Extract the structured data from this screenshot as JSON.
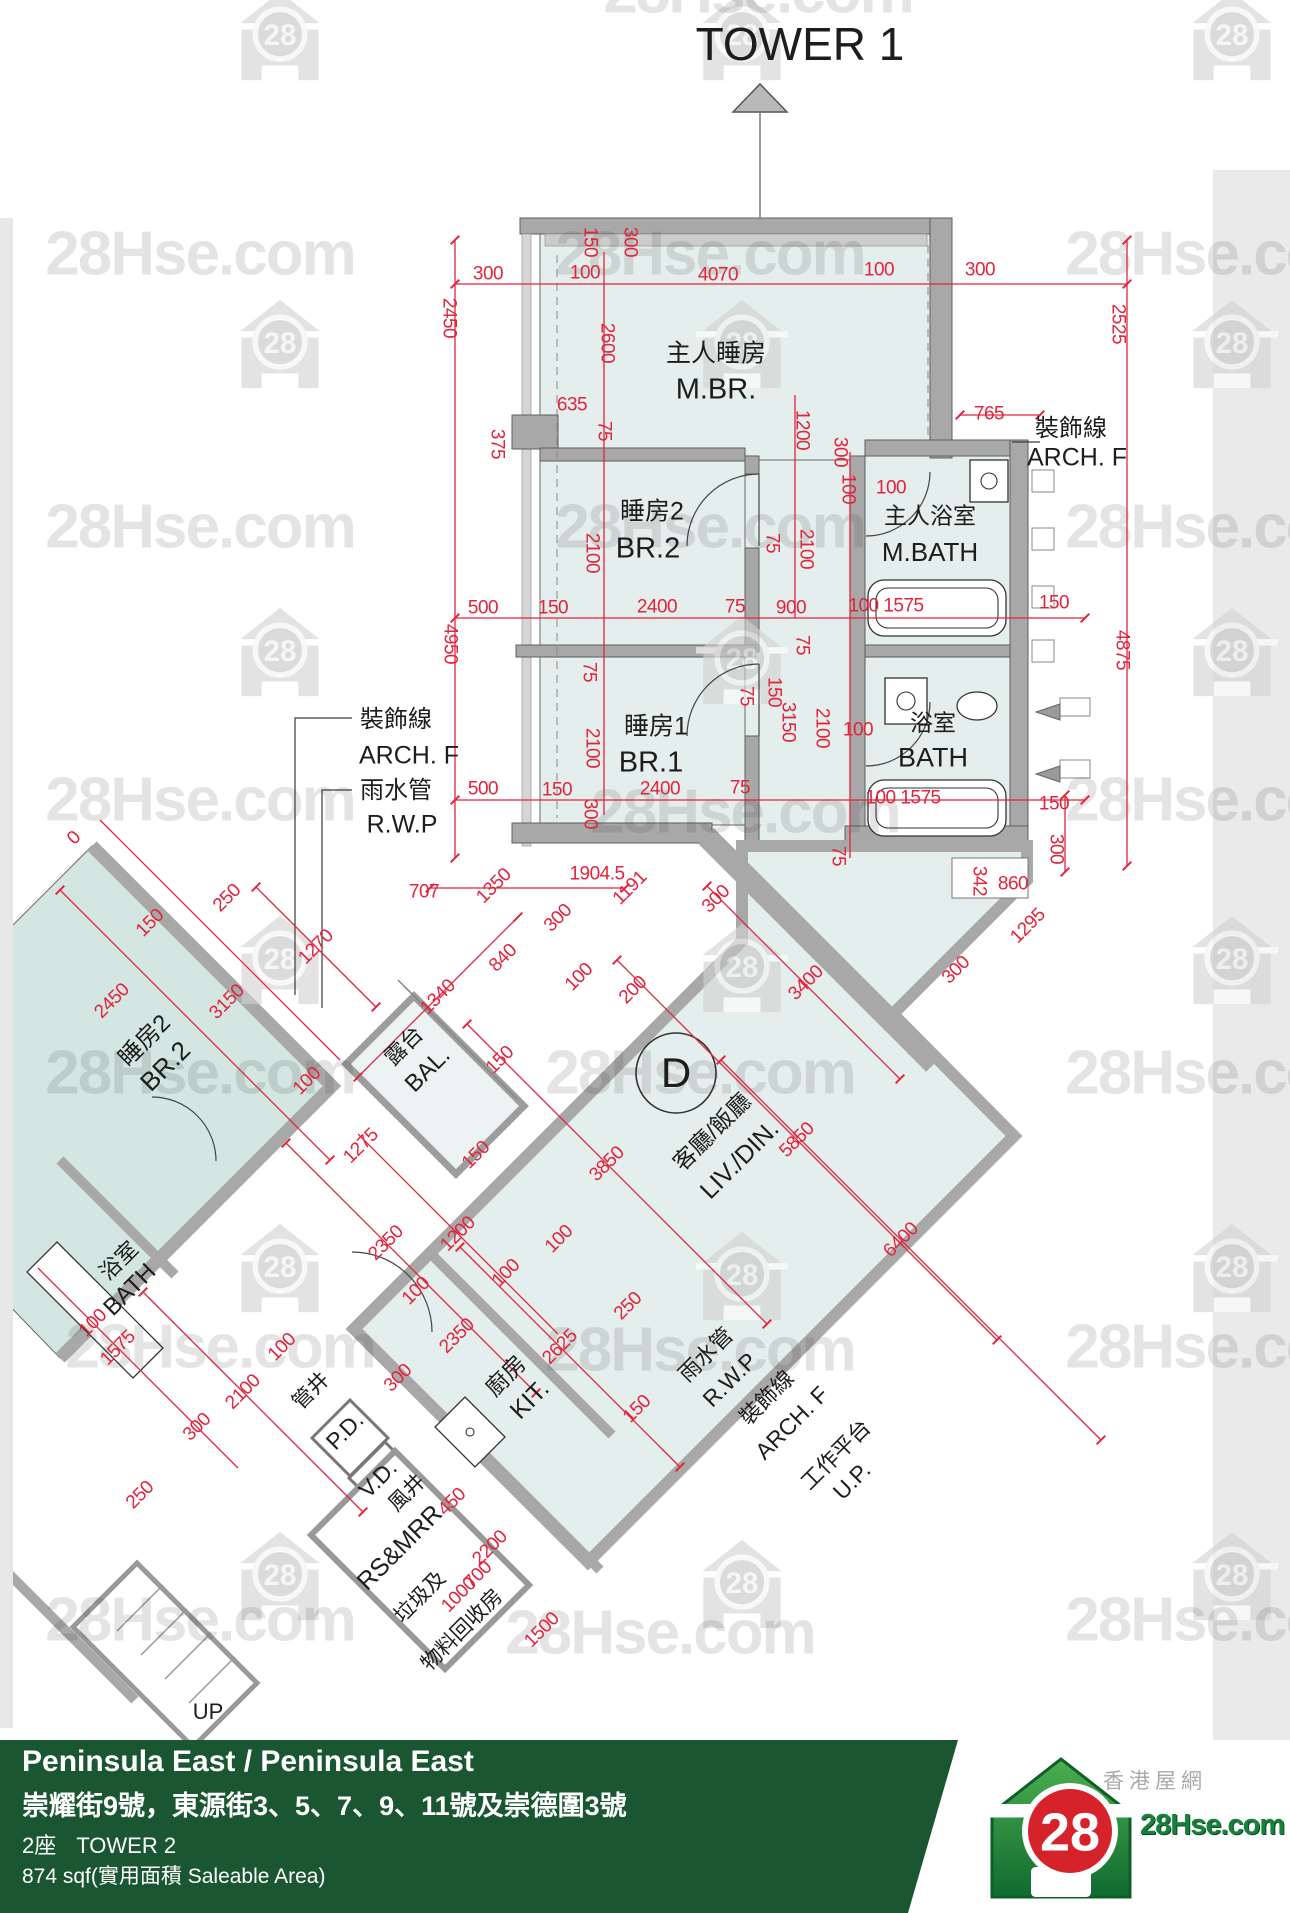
{
  "watermark": {
    "text": "28Hse.com",
    "houses": [
      [
        280,
        36
      ],
      [
        742,
        36
      ],
      [
        1232,
        36
      ],
      [
        280,
        344
      ],
      [
        742,
        344
      ],
      [
        1232,
        344
      ],
      [
        280,
        652
      ],
      [
        742,
        660
      ],
      [
        1232,
        652
      ],
      [
        280,
        960
      ],
      [
        742,
        968
      ],
      [
        1232,
        960
      ],
      [
        280,
        1268
      ],
      [
        742,
        1276
      ],
      [
        1232,
        1268
      ],
      [
        280,
        1576
      ],
      [
        742,
        1584
      ],
      [
        1232,
        1576
      ]
    ],
    "texts": [
      [
        758,
        -8
      ],
      [
        200,
        254
      ],
      [
        710,
        254
      ],
      [
        1220,
        254
      ],
      [
        200,
        527
      ],
      [
        710,
        527
      ],
      [
        1220,
        527
      ],
      [
        200,
        800
      ],
      [
        745,
        812
      ],
      [
        1220,
        800
      ],
      [
        200,
        1073
      ],
      [
        700,
        1073
      ],
      [
        1220,
        1073
      ],
      [
        220,
        1347
      ],
      [
        700,
        1350
      ],
      [
        1220,
        1347
      ],
      [
        200,
        1620
      ],
      [
        660,
        1633
      ],
      [
        1220,
        1620
      ]
    ]
  },
  "plan": {
    "labels": [
      [
        "TOWER 1",
        800,
        44,
        0,
        46
      ],
      [
        "主人睡房",
        716,
        354,
        0,
        25
      ],
      [
        "M.BR.",
        716,
        390,
        0,
        29
      ],
      [
        "睡房2",
        652,
        512,
        0,
        25
      ],
      [
        "BR.2",
        648,
        549,
        0,
        29
      ],
      [
        "睡房1",
        656,
        727,
        0,
        25
      ],
      [
        "BR.1",
        651,
        763,
        0,
        29
      ],
      [
        "主人浴室",
        930,
        516,
        0,
        23
      ],
      [
        "M.BATH",
        930,
        552,
        0,
        26
      ],
      [
        "浴室",
        933,
        723,
        0,
        23
      ],
      [
        "BATH",
        933,
        758,
        0,
        27
      ],
      [
        "裝飾線",
        1071,
        429,
        0,
        24
      ],
      [
        "ARCH. F",
        1077,
        458,
        0,
        25
      ],
      [
        "裝飾線",
        396,
        720,
        0,
        24
      ],
      [
        "ARCH. F",
        409,
        756,
        0,
        25
      ],
      [
        "雨水管",
        396,
        791,
        0,
        24
      ],
      [
        "R.W.P",
        402,
        825,
        0,
        25
      ],
      [
        "露台",
        404,
        1046,
        -45,
        22
      ],
      [
        "BAL.",
        428,
        1070,
        -45,
        24
      ],
      [
        "客廳/飯廳",
        712,
        1132,
        -45,
        23
      ],
      [
        "LIV./DIN.",
        740,
        1160,
        -45,
        25
      ],
      [
        "D",
        676,
        1073,
        0,
        42
      ],
      [
        "廚房",
        506,
        1376,
        -45,
        23
      ],
      [
        "KIT.",
        530,
        1400,
        -45,
        25
      ],
      [
        "管井",
        311,
        1391,
        -45,
        21
      ],
      [
        "P.D.",
        345,
        1431,
        -45,
        23
      ],
      [
        "V.D.",
        378,
        1479,
        -45,
        23
      ],
      [
        "風井",
        407,
        1493,
        -45,
        21
      ],
      [
        "RS&MRR",
        400,
        1548,
        -45,
        25
      ],
      [
        "垃圾及",
        420,
        1597,
        -45,
        21
      ],
      [
        "物料回收房",
        462,
        1630,
        -45,
        21
      ],
      [
        "雨水管",
        706,
        1355,
        -45,
        22
      ],
      [
        "R.W.P",
        730,
        1380,
        -45,
        23
      ],
      [
        "裝飾線",
        767,
        1398,
        -45,
        22
      ],
      [
        "ARCH. F",
        792,
        1423,
        -45,
        23
      ],
      [
        "工作平台",
        836,
        1455,
        -45,
        22
      ],
      [
        "U.P.",
        852,
        1481,
        -45,
        23
      ],
      [
        "睡房2",
        145,
        1041,
        -45,
        24
      ],
      [
        "BR.2",
        165,
        1066,
        -45,
        26
      ],
      [
        "浴室",
        119,
        1261,
        -45,
        22
      ],
      [
        "BATH",
        130,
        1290,
        -45,
        24
      ],
      [
        "UP",
        208,
        1712,
        0,
        22
      ]
    ],
    "dims": [
      [
        "300",
        488,
        274,
        0
      ],
      [
        "100",
        585,
        273,
        0
      ],
      [
        "4070",
        718,
        275,
        0
      ],
      [
        "100",
        879,
        270,
        0
      ],
      [
        "300",
        980,
        270,
        0
      ],
      [
        "150",
        590,
        242,
        90
      ],
      [
        "300",
        630,
        242,
        90
      ],
      [
        "2450",
        449,
        318,
        90
      ],
      [
        "2525",
        1118,
        324,
        90
      ],
      [
        "2600",
        607,
        343,
        90
      ],
      [
        "635",
        572,
        405,
        0
      ],
      [
        "75",
        604,
        431,
        90
      ],
      [
        "1200",
        802,
        430,
        90
      ],
      [
        "300",
        840,
        452,
        90
      ],
      [
        "765",
        989,
        414,
        0
      ],
      [
        "375",
        497,
        444,
        90
      ],
      [
        "100",
        891,
        488,
        0
      ],
      [
        "100",
        848,
        489,
        90
      ],
      [
        "2100",
        592,
        553,
        90
      ],
      [
        "75",
        772,
        543,
        90
      ],
      [
        "2100",
        806,
        549,
        90
      ],
      [
        "500",
        483,
        608,
        0
      ],
      [
        "150",
        553,
        608,
        0
      ],
      [
        "2400",
        657,
        607,
        0
      ],
      [
        "75",
        735,
        607,
        0
      ],
      [
        "900",
        791,
        608,
        0
      ],
      [
        "100 1575",
        886,
        606,
        0
      ],
      [
        "150",
        1054,
        603,
        0
      ],
      [
        "4950",
        450,
        644,
        90
      ],
      [
        "4875",
        1122,
        650,
        90
      ],
      [
        "75",
        589,
        672,
        90
      ],
      [
        "75",
        746,
        696,
        90
      ],
      [
        "150",
        774,
        692,
        90
      ],
      [
        "75",
        802,
        645,
        90
      ],
      [
        "2100",
        592,
        748,
        90
      ],
      [
        "3150",
        788,
        722,
        90
      ],
      [
        "2100",
        822,
        728,
        90
      ],
      [
        "100",
        858,
        730,
        0
      ],
      [
        "500",
        483,
        789,
        0
      ],
      [
        "150",
        557,
        790,
        0
      ],
      [
        "2400",
        660,
        789,
        0
      ],
      [
        "75",
        740,
        788,
        0
      ],
      [
        "100 1575",
        903,
        798,
        0
      ],
      [
        "150",
        1054,
        804,
        0
      ],
      [
        "300",
        590,
        814,
        90
      ],
      [
        "75",
        838,
        856,
        90
      ],
      [
        "300",
        1056,
        849,
        90
      ],
      [
        "342",
        979,
        881,
        90
      ],
      [
        "860",
        1013,
        884,
        0
      ],
      [
        "1904.5",
        597,
        874,
        0
      ],
      [
        "707",
        424,
        892,
        0
      ],
      [
        "1350",
        494,
        886,
        -45
      ],
      [
        "1191",
        630,
        888,
        -45
      ],
      [
        "300",
        716,
        899,
        -45
      ],
      [
        "1295",
        1028,
        926,
        -45
      ],
      [
        "300",
        956,
        970,
        -45
      ],
      [
        "3400",
        806,
        983,
        -45
      ],
      [
        "1270",
        316,
        947,
        -45
      ],
      [
        "300",
        558,
        918,
        -45
      ],
      [
        "840",
        503,
        958,
        -45
      ],
      [
        "100",
        579,
        977,
        -45
      ],
      [
        "200",
        633,
        990,
        -45
      ],
      [
        "1340",
        438,
        997,
        -45
      ],
      [
        "150",
        500,
        1060,
        -45
      ],
      [
        "250",
        227,
        898,
        -45
      ],
      [
        "150",
        150,
        923,
        -45
      ],
      [
        "2450",
        112,
        1001,
        -45
      ],
      [
        "3150",
        227,
        1002,
        -45
      ],
      [
        "100",
        307,
        1081,
        -45
      ],
      [
        "0",
        74,
        838,
        -45
      ],
      [
        "5850",
        797,
        1140,
        -45
      ],
      [
        "3850",
        607,
        1164,
        -45
      ],
      [
        "6400",
        901,
        1240,
        -45
      ],
      [
        "1275",
        361,
        1146,
        -45
      ],
      [
        "150",
        476,
        1155,
        -45
      ],
      [
        "1200",
        458,
        1234,
        -45
      ],
      [
        "2350",
        386,
        1243,
        -45
      ],
      [
        "100",
        559,
        1239,
        -45
      ],
      [
        "100",
        416,
        1291,
        -45
      ],
      [
        "100",
        506,
        1273,
        -45
      ],
      [
        "250",
        628,
        1306,
        -45
      ],
      [
        "2625",
        560,
        1347,
        -45
      ],
      [
        "2350",
        457,
        1336,
        -45
      ],
      [
        "300",
        398,
        1378,
        -45
      ],
      [
        "150",
        637,
        1409,
        -45
      ],
      [
        "2100",
        243,
        1392,
        -45
      ],
      [
        "300",
        197,
        1427,
        -45
      ],
      [
        "250",
        140,
        1495,
        -45
      ],
      [
        "100",
        282,
        1347,
        -45
      ],
      [
        "1575",
        118,
        1348,
        -45
      ],
      [
        "100",
        93,
        1323,
        -45
      ],
      [
        "450",
        452,
        1502,
        -45
      ],
      [
        "2200",
        490,
        1548,
        -45
      ],
      [
        "700",
        478,
        1575,
        -45
      ],
      [
        "1000",
        459,
        1595,
        -45
      ],
      [
        "1500",
        542,
        1630,
        -45
      ]
    ]
  },
  "footer": {
    "building": "Peninsula East / Peninsula East",
    "address": "崇耀街9號，東源街3、5、7、9、11號及崇德圍3號",
    "block_zh": "2座",
    "block_en": "TOWER 2",
    "area": "874 sqf(實用面積 Saleable Area)"
  },
  "logo": {
    "zh": "香港屋網",
    "site": "28Hse.com",
    "badge": "28"
  }
}
